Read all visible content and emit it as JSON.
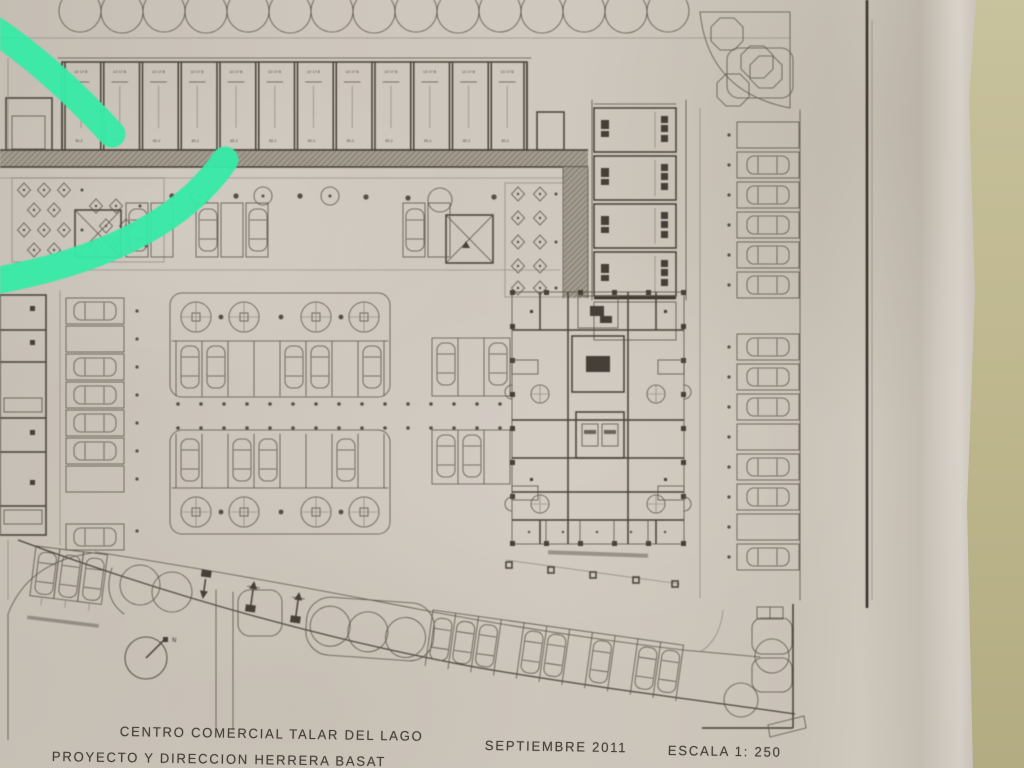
{
  "photo": {
    "description": "Photographed architectural site plan on beige paper with a teal highlighter arc",
    "marker_color": "#38e9a7",
    "paper_color": "#cdc6bc",
    "desk_color": "#bdb58d",
    "ink_color": "#4a443c"
  },
  "title_block": {
    "project": "CENTRO COMERCIAL TALAR DEL LAGO",
    "credit": "PROYECTO Y DIRECCION HERRERA BASAT",
    "date": "SEPTIEMBRE 2011",
    "scale": "ESCALA 1: 250"
  },
  "plan": {
    "units": {
      "top_label": "LO 17 B",
      "area_label": "85.2"
    },
    "compass": {
      "label": "N"
    }
  }
}
